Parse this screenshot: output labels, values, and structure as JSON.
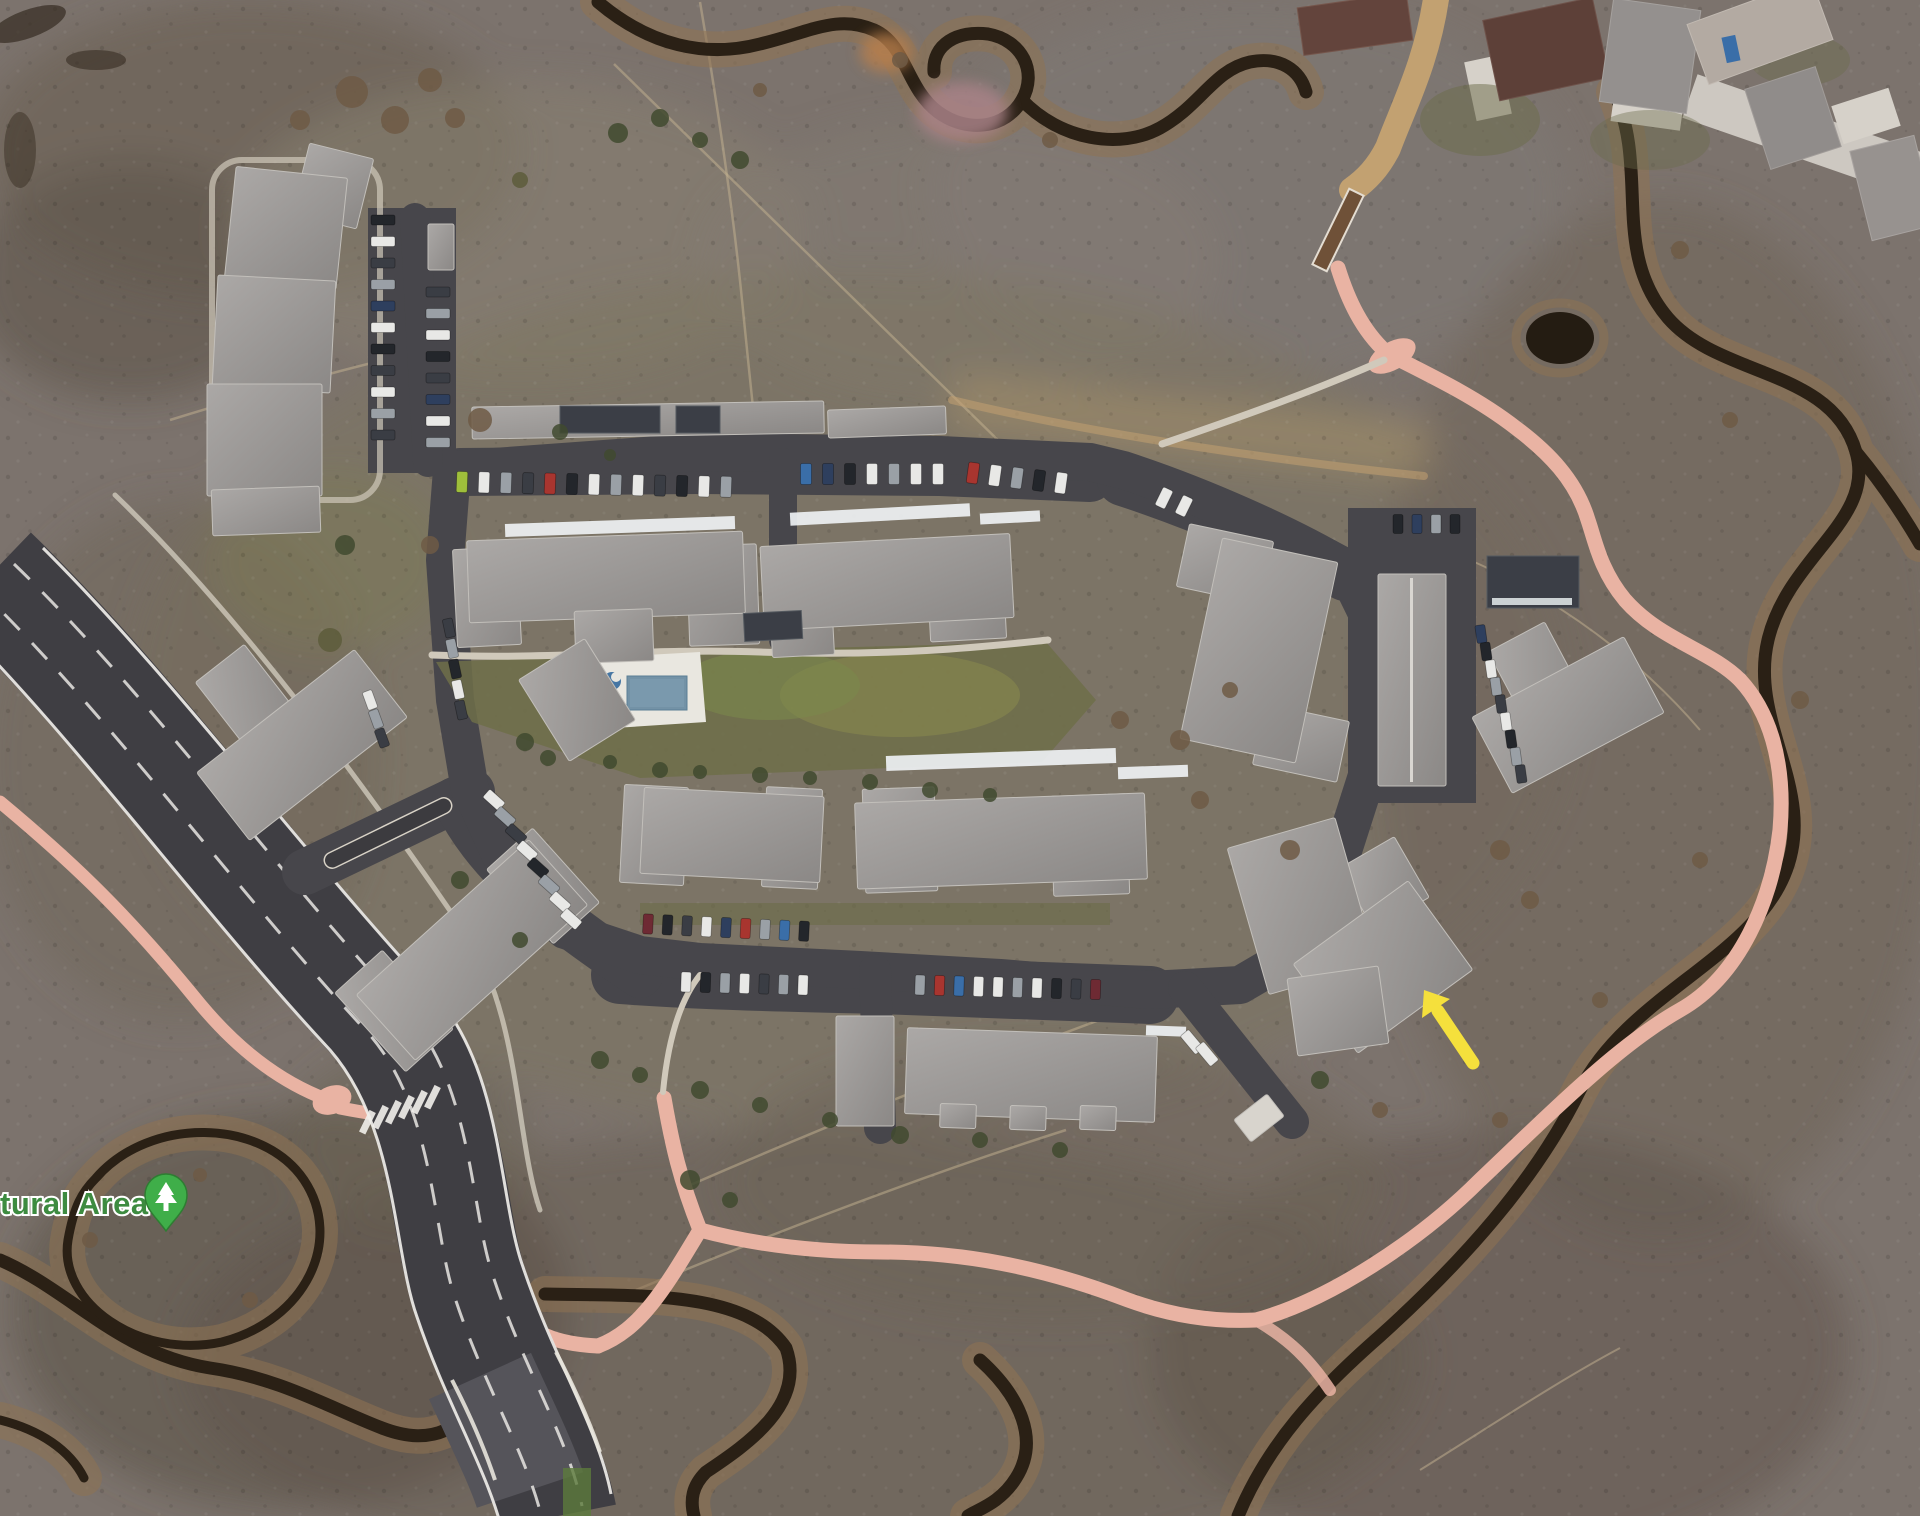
{
  "map": {
    "view": "satellite",
    "poi_label": {
      "text": "tural Area"
    },
    "poi_icon": "park-tree-pin",
    "annotation": {
      "type": "arrow",
      "points_at": "condo-building-southeast"
    }
  },
  "colors": {
    "terrain": "#7c736d",
    "highway": "#3f3e43",
    "loop": "#47464b",
    "path": "#e9b3a3",
    "trail": "#c2a171",
    "walk": "#d0c9bb",
    "lawn": "#6e6f49",
    "pool": "#7392a6",
    "spa": "#4676a3",
    "deck": "#e9e7e0",
    "creek": "#2a2015",
    "bank": "#8f7352",
    "label": "#3d8b40",
    "pin": "#3fae49",
    "pin_dark": "#2e7d32",
    "arrow": "#f5e03c",
    "snow": "#eef1f3",
    "roof_dark": "#3b3e46"
  },
  "scene": {
    "car_palette": {
      "d": "#3a3d44",
      "k": "#23262b",
      "w": "#e8e8e6",
      "s": "#9aa0a6",
      "n": "#2e3f5e",
      "b": "#3a6ea8",
      "r": "#a8352f",
      "m": "#6e2a33",
      "g": "#9fbf3b",
      "t": "#b0a184"
    },
    "car_rows": [
      {
        "x": 383,
        "y": 220,
        "dx": 0,
        "dy": 21.5,
        "w": 24,
        "h": 10,
        "rot": 0,
        "c": "kwdsnwkdwsd"
      },
      {
        "x": 438,
        "y": 292,
        "dx": 0,
        "dy": 21.5,
        "w": 24,
        "h": 10,
        "rot": 0,
        "c": "dswkdnws"
      },
      {
        "x": 462,
        "y": 482,
        "dx": 22,
        "dy": 0.4,
        "w": 11,
        "h": 21,
        "rot": 2,
        "c": "gwsdrkwswdkws"
      },
      {
        "x": 806,
        "y": 474,
        "dx": 22,
        "dy": 0,
        "w": 11,
        "h": 21,
        "rot": 0,
        "c": "bnkwsww"
      },
      {
        "x": 973,
        "y": 473,
        "dx": 22,
        "dy": 2.5,
        "w": 11,
        "h": 21,
        "rot": 8,
        "c": "rwskw"
      },
      {
        "x": 1164,
        "y": 498,
        "dx": 20,
        "dy": 8,
        "w": 11,
        "h": 20,
        "rot": 26,
        "c": "ww"
      },
      {
        "x": 1398,
        "y": 524,
        "dx": 19,
        "dy": 0,
        "w": 10,
        "h": 19,
        "rot": 0,
        "c": "knsk"
      },
      {
        "x": 1481,
        "y": 634,
        "dx": 5,
        "dy": 17.5,
        "w": 10,
        "h": 18,
        "rot": -8,
        "c": "nkwsdwksd"
      },
      {
        "x": 494,
        "y": 800,
        "dx": 11,
        "dy": 17,
        "w": 11,
        "h": 21,
        "rot": -48,
        "c": "wsdwksww"
      },
      {
        "x": 449,
        "y": 628,
        "dx": 3,
        "dy": 20.5,
        "w": 10,
        "h": 19,
        "rot": -12,
        "c": "dskwd"
      },
      {
        "x": 648,
        "y": 924,
        "dx": 19.5,
        "dy": 0.9,
        "w": 10,
        "h": 20,
        "rot": 3,
        "c": "mkdwnrsbk"
      },
      {
        "x": 686,
        "y": 982,
        "dx": 19.5,
        "dy": 0.5,
        "w": 10,
        "h": 20,
        "rot": 2,
        "c": "wkswdsw"
      },
      {
        "x": 920,
        "y": 985,
        "dx": 19.5,
        "dy": 0.5,
        "w": 10,
        "h": 20,
        "rot": 2,
        "c": "srbwwswkdm"
      },
      {
        "x": 1192,
        "y": 1042,
        "dx": 15,
        "dy": 12,
        "w": 11,
        "h": 24,
        "rot": -40,
        "c": "ww"
      },
      {
        "x": 370,
        "y": 700,
        "dx": 6,
        "dy": 19,
        "w": 10,
        "h": 19,
        "rot": -20,
        "c": "wsd"
      }
    ],
    "trees": [
      [
        352,
        92,
        16,
        "b"
      ],
      [
        395,
        120,
        14,
        "b"
      ],
      [
        430,
        80,
        12,
        "b"
      ],
      [
        300,
        120,
        10,
        "b"
      ],
      [
        455,
        118,
        10,
        "b"
      ],
      [
        618,
        133,
        10,
        "g"
      ],
      [
        660,
        118,
        9,
        "g"
      ],
      [
        700,
        140,
        8,
        "g"
      ],
      [
        740,
        160,
        9,
        "g"
      ],
      [
        520,
        180,
        8,
        "o"
      ],
      [
        900,
        60,
        8,
        "b"
      ],
      [
        1050,
        140,
        8,
        "b"
      ],
      [
        760,
        90,
        7,
        "b"
      ],
      [
        480,
        420,
        12,
        "b"
      ],
      [
        560,
        432,
        8,
        "g"
      ],
      [
        610,
        455,
        6,
        "g"
      ],
      [
        345,
        545,
        10,
        "g"
      ],
      [
        430,
        545,
        9,
        "b"
      ],
      [
        330,
        640,
        12,
        "o"
      ],
      [
        525,
        742,
        9,
        "g"
      ],
      [
        548,
        758,
        8,
        "g"
      ],
      [
        610,
        762,
        7,
        "g"
      ],
      [
        660,
        770,
        8,
        "g"
      ],
      [
        700,
        772,
        7,
        "g"
      ],
      [
        760,
        775,
        8,
        "g"
      ],
      [
        810,
        778,
        7,
        "g"
      ],
      [
        870,
        782,
        8,
        "g"
      ],
      [
        930,
        790,
        8,
        "g"
      ],
      [
        990,
        795,
        7,
        "g"
      ],
      [
        460,
        880,
        9,
        "g"
      ],
      [
        520,
        940,
        8,
        "g"
      ],
      [
        600,
        1060,
        9,
        "g"
      ],
      [
        640,
        1075,
        8,
        "g"
      ],
      [
        700,
        1090,
        9,
        "g"
      ],
      [
        760,
        1105,
        8,
        "g"
      ],
      [
        830,
        1120,
        8,
        "g"
      ],
      [
        900,
        1135,
        9,
        "g"
      ],
      [
        980,
        1140,
        8,
        "g"
      ],
      [
        1060,
        1150,
        8,
        "g"
      ],
      [
        1120,
        720,
        9,
        "b"
      ],
      [
        1180,
        740,
        10,
        "b"
      ],
      [
        1230,
        690,
        8,
        "b"
      ],
      [
        1200,
        800,
        9,
        "b"
      ],
      [
        1290,
        850,
        10,
        "b"
      ],
      [
        1320,
        1080,
        9,
        "g"
      ],
      [
        1380,
        1110,
        8,
        "b"
      ],
      [
        1500,
        850,
        10,
        "b"
      ],
      [
        1530,
        900,
        9,
        "b"
      ],
      [
        90,
        1240,
        8,
        "b"
      ],
      [
        200,
        1175,
        7,
        "b"
      ],
      [
        250,
        1300,
        8,
        "b"
      ],
      [
        690,
        1180,
        10,
        "g"
      ],
      [
        730,
        1200,
        8,
        "g"
      ],
      [
        1680,
        250,
        9,
        "b"
      ],
      [
        1730,
        420,
        8,
        "b"
      ],
      [
        1800,
        700,
        9,
        "b"
      ],
      [
        1700,
        860,
        8,
        "b"
      ],
      [
        1600,
        1000,
        8,
        "b"
      ],
      [
        1500,
        1120,
        8,
        "b"
      ]
    ],
    "tree_palette": {
      "g": "#414a2f",
      "b": "#6f5b45",
      "o": "#5d5c3b"
    }
  }
}
